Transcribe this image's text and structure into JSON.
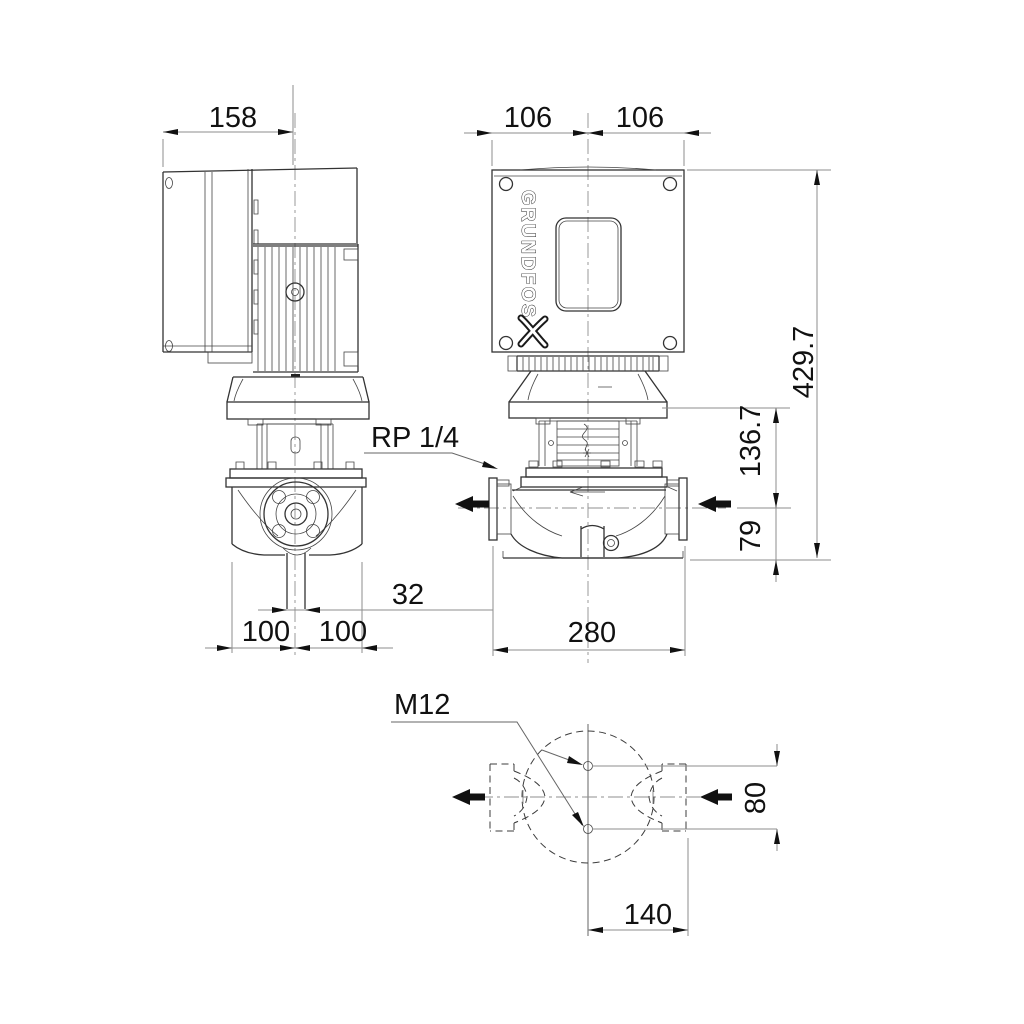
{
  "labels": {
    "brand": "GRUNDFOS",
    "side_width": "158",
    "front_left_half": "106",
    "front_right_half": "106",
    "overall_height": "429.7",
    "flange_to_shaft": "136.7",
    "shaft_to_base": "79",
    "gauge_port": "RP 1/4",
    "drain_width": "32",
    "foot_left": "100",
    "foot_right": "100",
    "port_to_port": "280",
    "tapping": "M12",
    "hole_offset": "80",
    "center_to_face": "140"
  },
  "colors": {
    "outline": "#333333",
    "dimension": "#8d8d8d",
    "text": "#111111",
    "background": "#ffffff"
  }
}
